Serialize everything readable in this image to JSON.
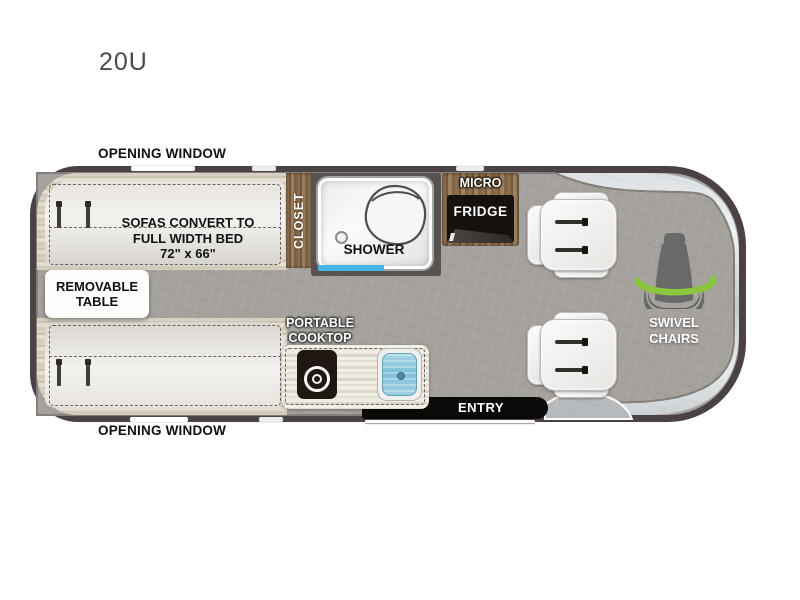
{
  "model": {
    "label": "20U"
  },
  "exterior": {
    "opening_window_top": "OPENING WINDOW",
    "opening_window_bottom": "OPENING WINDOW"
  },
  "features": {
    "sofa_note": {
      "line1": "SOFAS CONVERT TO",
      "line2": "FULL WIDTH BED",
      "line3": "72\" x 66\""
    },
    "removable_table": "REMOVABLE TABLE",
    "closet": "CLOSET",
    "shower": "SHOWER",
    "micro": "MICRO",
    "fridge": "FRIDGE",
    "portable_cooktop": {
      "line1": "PORTABLE",
      "line2": "COOKTOP"
    },
    "entry": "ENTRY",
    "swivel_chairs": {
      "line1": "SWIVEL",
      "line2": "CHAIRS"
    }
  },
  "icons": {
    "swivel_seat": "captain-seat-silhouette-with-green-rotation-arrow",
    "toilet": "toilet-oval-outline",
    "burner": "concentric-circles",
    "seatbelt": "vertical-post"
  },
  "colors": {
    "body_outline": "#4a4244",
    "floor_gray": "#a7a4a0",
    "cabin_silver": "#dfe3e6",
    "wood_brown": "#85684a",
    "sofa_beige": "#d8d1c3",
    "accent_green": "#8cc63e",
    "shower_door_blue": "#44b6e8",
    "sink_blue": "#7ec1da",
    "appliance_black": "#17110d"
  }
}
